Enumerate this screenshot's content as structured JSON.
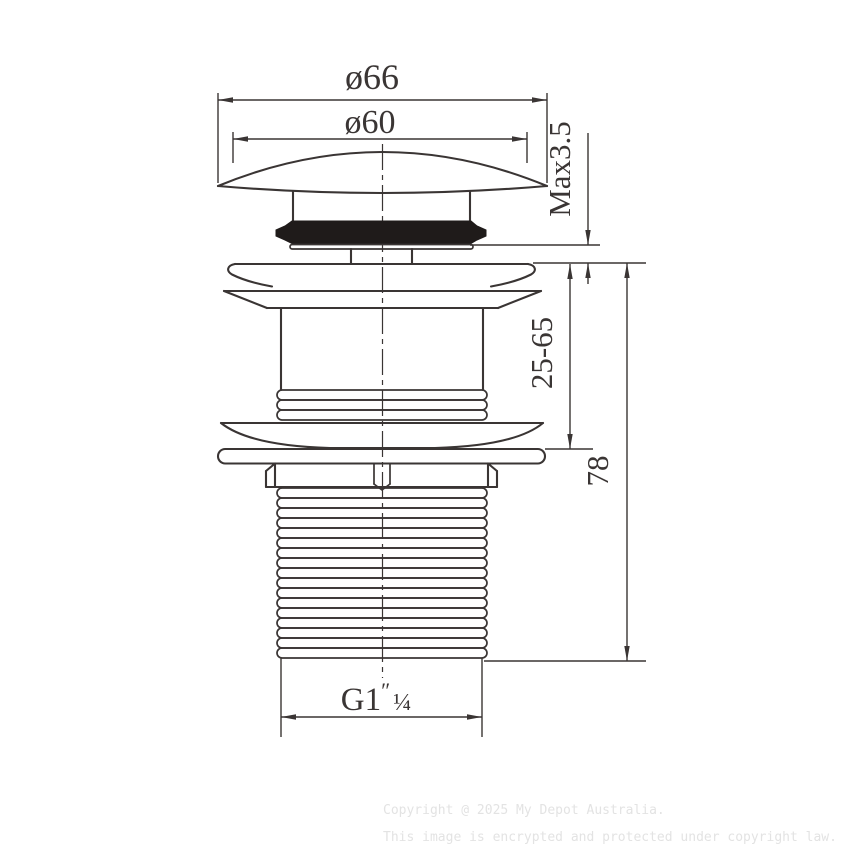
{
  "labels": {
    "dia_outer": "ø66",
    "dia_top": "ø60",
    "max_height": "Max3.5",
    "install_range": "25-65",
    "body_length": "78",
    "thread_g": "G1",
    "thread_prime": "″",
    "thread_fraction": "¼"
  },
  "watermark": {
    "line1": "Copyright @ 2025 My Depot Australia.",
    "line2": "This image is encrypted and protected under copyright law."
  },
  "colors": {
    "line": "#3a3534",
    "seal": "#1f1b1a",
    "watermark": "#e3e3e3",
    "background": "#ffffff"
  }
}
